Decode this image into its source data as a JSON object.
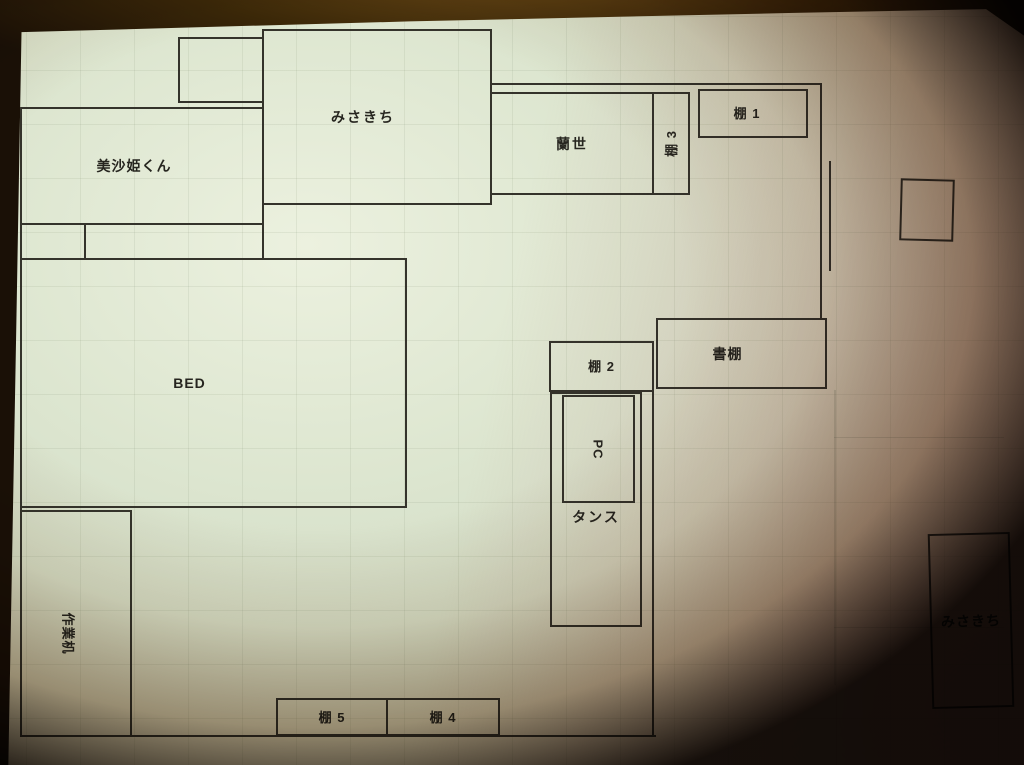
{
  "plan": {
    "labels": {
      "misakichi_top": "みさきち",
      "misakihime_kun": "美沙姫くん",
      "ranze": "蘭世",
      "shelf3": "棚 3",
      "shelf1": "棚 1",
      "bed": "BED",
      "shelf2": "棚 2",
      "bookshelf": "書棚",
      "pc": "PC",
      "tansu": "タンス",
      "work_desk": "作業机",
      "shelf5": "棚 5",
      "shelf4": "棚 4",
      "misakichi_bottom_right": "みさきち"
    },
    "colors": {
      "paper": "#d6dfc9",
      "paper_highlight": "#ecf1df",
      "ink_line": "#34332b",
      "label_text": "#26251f",
      "table_background": "#2a1a06",
      "pink_color_cast": "#c08a92"
    }
  }
}
